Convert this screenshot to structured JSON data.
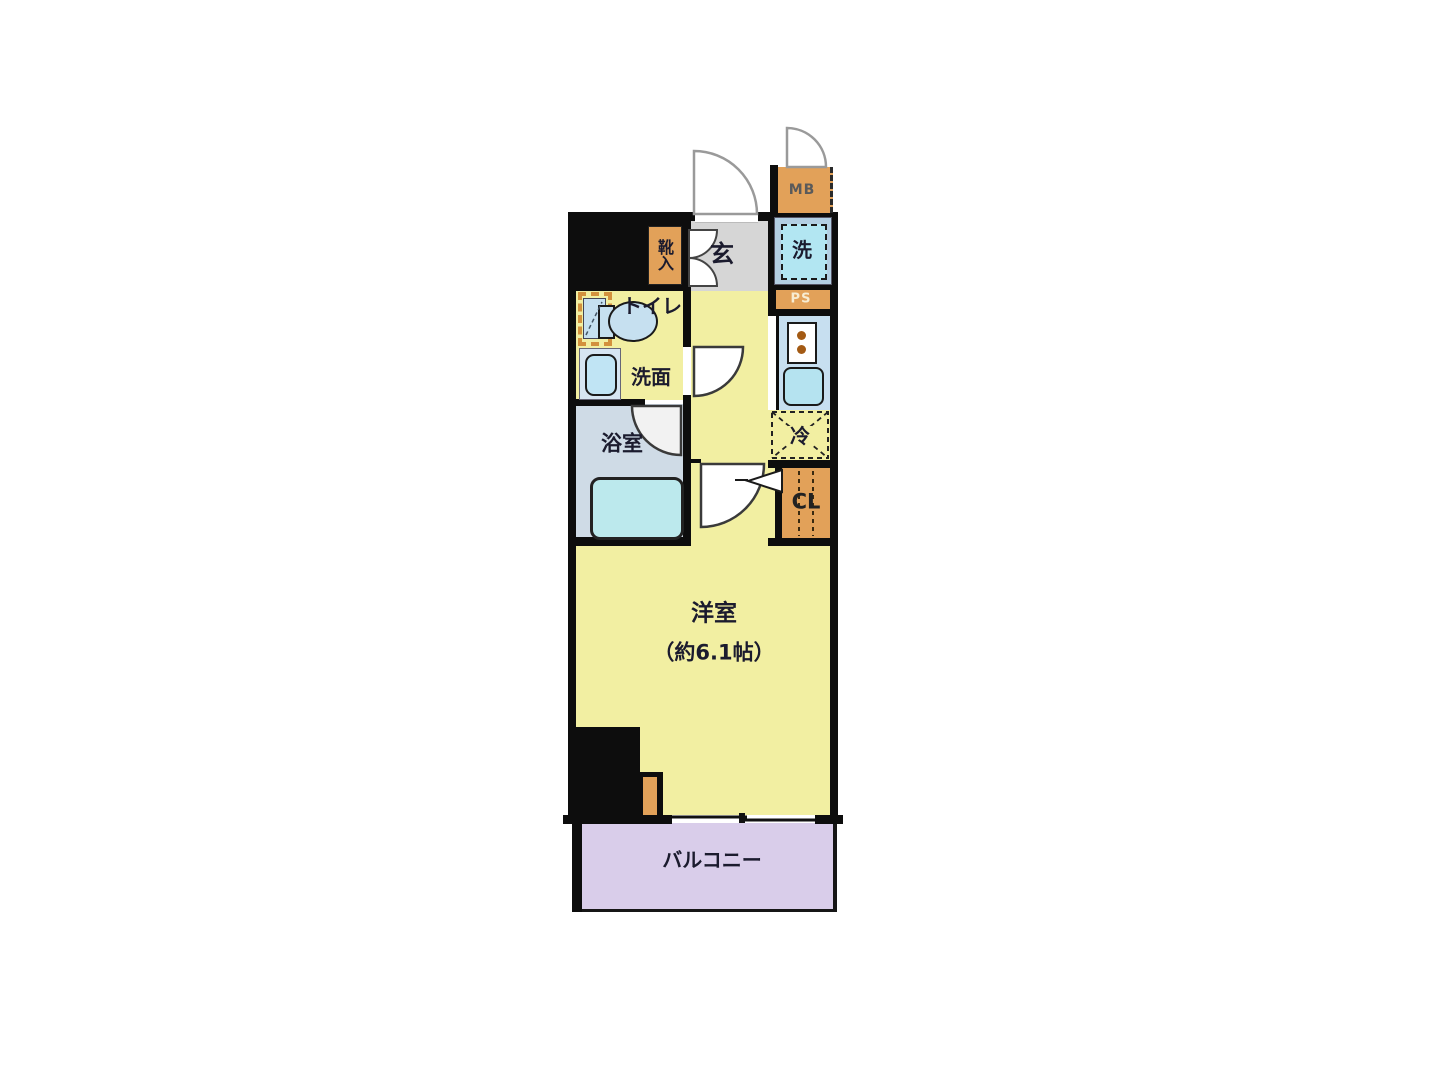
{
  "floorplan": {
    "rooms": {
      "entrance": "玄",
      "shoe_cabinet": "靴入",
      "meter_box": "MB",
      "washer": "洗",
      "pipe_space": "PS",
      "toilet": "トイレ",
      "washroom": "洗面",
      "bathroom": "浴室",
      "refrigerator": "冷",
      "closet": "CL",
      "western_room": "洋室",
      "western_room_size": "（約6.1帖）",
      "balcony": "バルコニー"
    },
    "colors": {
      "room_yellow": "#f2efa2",
      "entrance_gray": "#d6d6d6",
      "bathroom_blue": "#cfdbe6",
      "kitchen_blue": "#c7dff0",
      "fixture_cyan": "#b2e6f2",
      "cabinet_orange": "#e2a159",
      "balcony_lavender": "#d9cdea",
      "wall_black": "#0d0d0d"
    }
  }
}
